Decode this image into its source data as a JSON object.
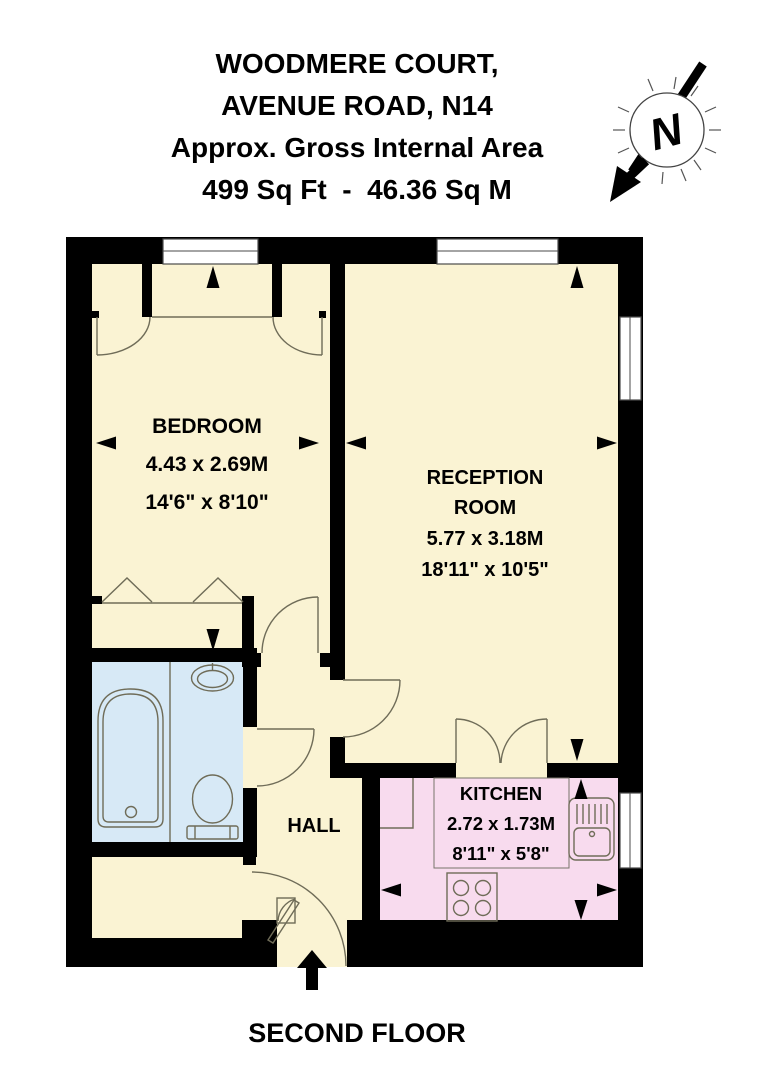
{
  "header": {
    "line1": "WOODMERE COURT,",
    "line2": "AVENUE ROAD, N14",
    "line3": "Approx. Gross Internal Area",
    "line4": "499 Sq Ft  -  46.36 Sq M"
  },
  "compass": {
    "letter": "N"
  },
  "rooms": {
    "bedroom": {
      "name": "BEDROOM",
      "dims_m": "4.43 x 2.69M",
      "dims_ft": "14'6\" x 8'10\""
    },
    "reception": {
      "name_line1": "RECEPTION",
      "name_line2": "ROOM",
      "dims_m": "5.77 x 3.18M",
      "dims_ft": "18'11\" x 10'5\""
    },
    "kitchen": {
      "name": "KITCHEN",
      "dims_m": "2.72 x 1.73M",
      "dims_ft": "8'11\" x 5'8\""
    },
    "hall": {
      "name": "HALL"
    },
    "bathroom": {
      "name": ""
    }
  },
  "footer": {
    "floor_label": "SECOND FLOOR"
  },
  "colors": {
    "floor_cream": "#FAF3D3",
    "bathroom_blue": "#D7E9F6",
    "kitchen_pink": "#F8DBEE",
    "wall_black": "#000000",
    "detail_line": "#6F6C58"
  }
}
